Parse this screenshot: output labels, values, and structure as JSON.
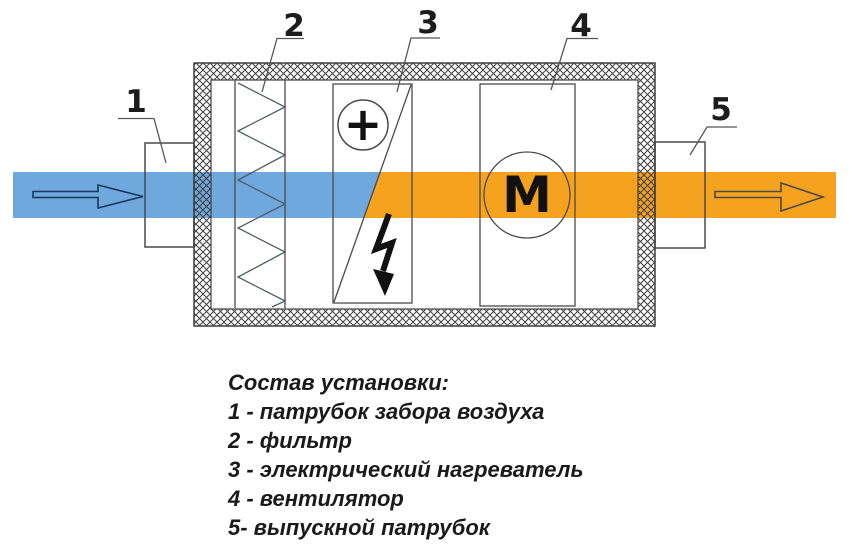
{
  "colors": {
    "intake-air": "#6FA8DC",
    "heated-air": "#F5A21F",
    "outline": "#4a4a4a",
    "hatch": "#3f3f3f",
    "symbol": "#111111"
  },
  "callouts": [
    {
      "number": "1"
    },
    {
      "number": "2"
    },
    {
      "number": "3"
    },
    {
      "number": "4"
    },
    {
      "number": "5"
    }
  ],
  "symbols": {
    "heater_sign": "+",
    "motor_letter": "M"
  },
  "legend": {
    "heading": "Состав установки:",
    "items": [
      "1 - патрубок забора воздуха",
      "2 - фильтр",
      "3 - электрический нагреватель",
      "4 - вентилятор",
      "5- выпускной патрубок"
    ]
  }
}
